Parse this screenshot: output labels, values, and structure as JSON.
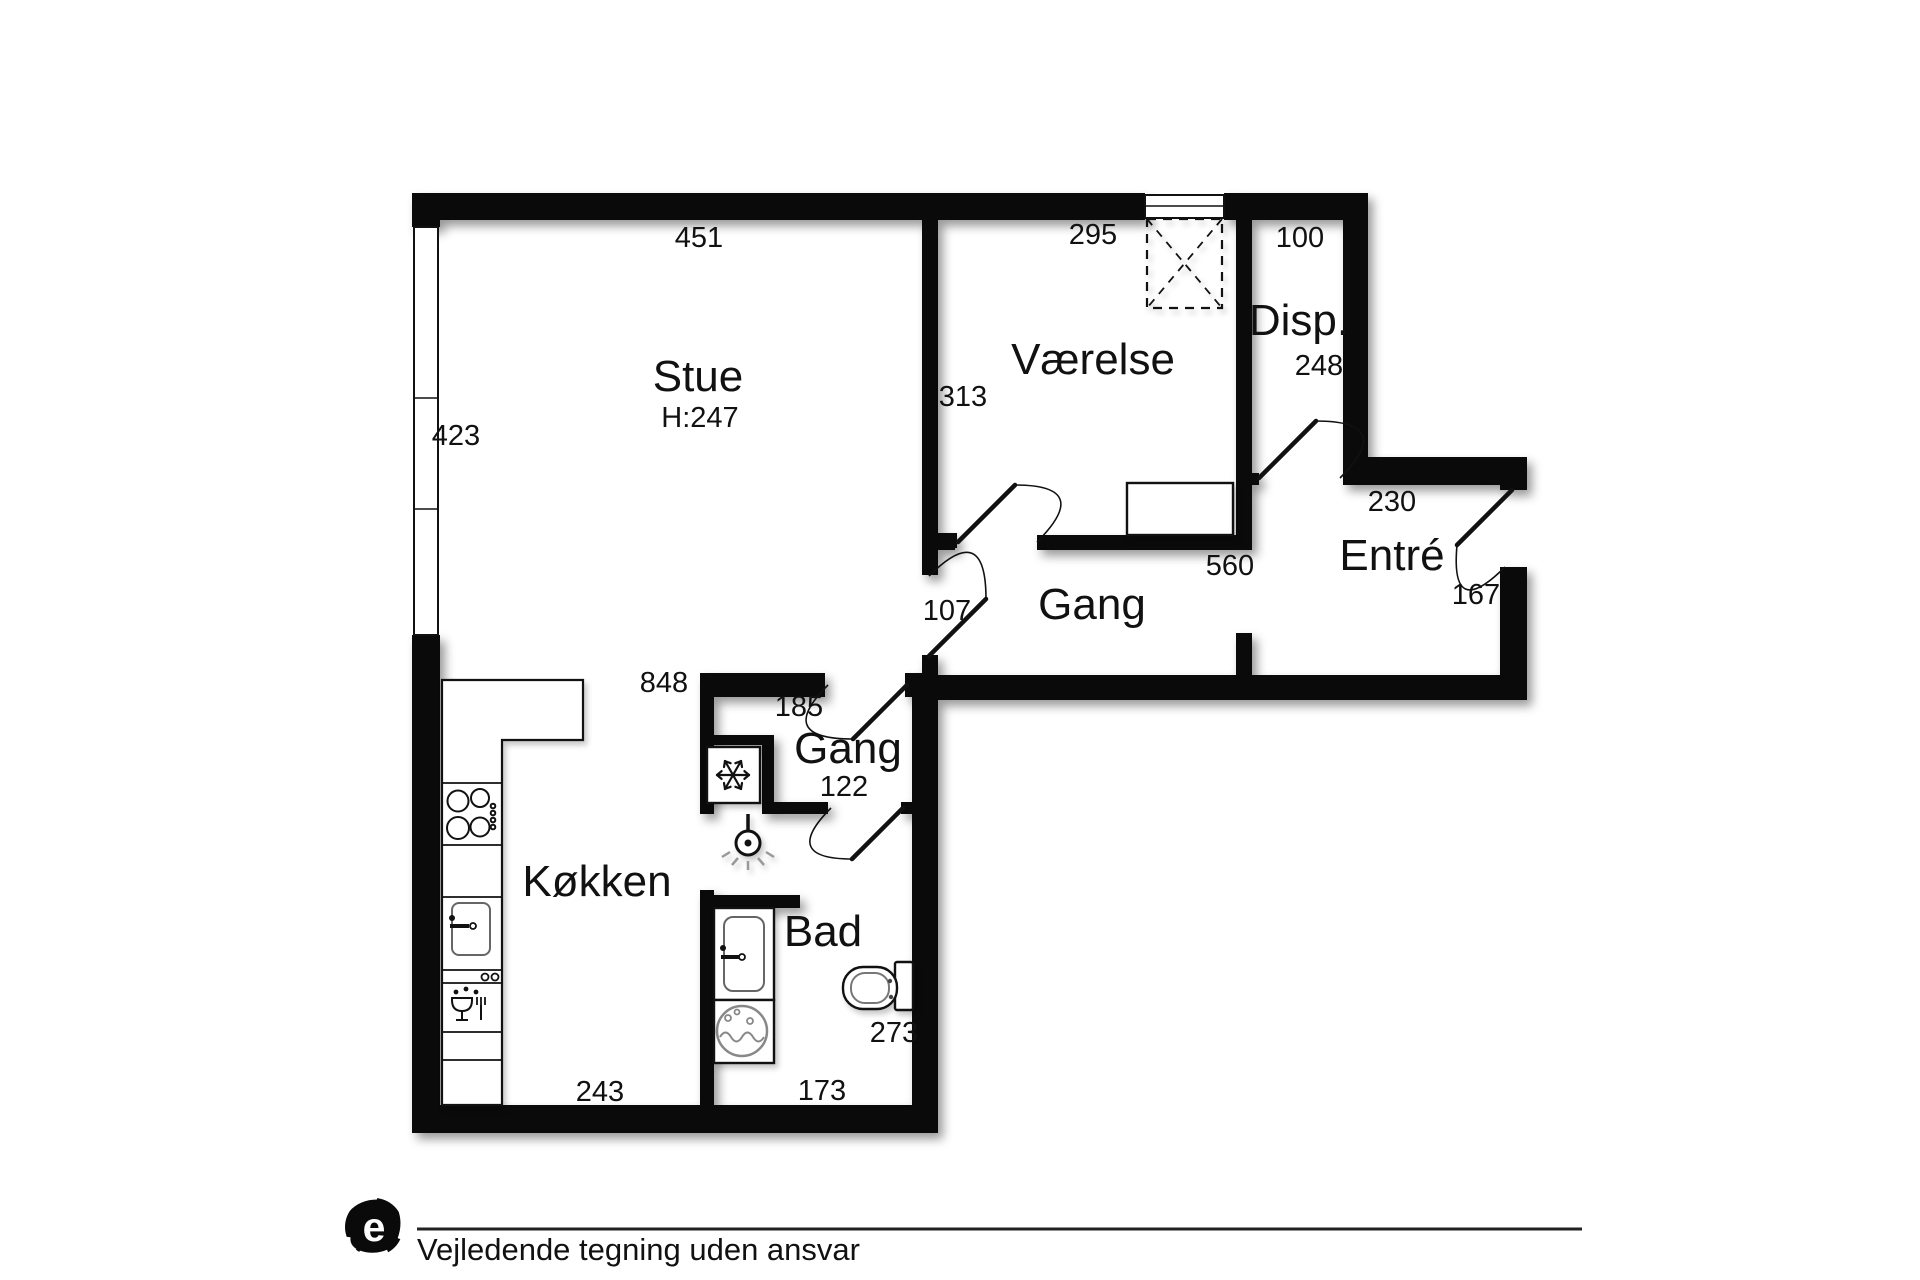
{
  "floorplan": {
    "rooms": [
      {
        "name": "Stue",
        "ceiling_height": "H:247",
        "dims": [
          "451",
          "423"
        ]
      },
      {
        "name": "Værelse",
        "dims": [
          "295",
          "313"
        ]
      },
      {
        "name": "Disp.",
        "dims": [
          "100",
          "248"
        ]
      },
      {
        "name": "Entré",
        "dims": [
          "230",
          "167"
        ]
      },
      {
        "name": "Gang",
        "dims": [
          "560",
          "107"
        ]
      },
      {
        "name": "Gang",
        "dims": [
          "848",
          "185",
          "122"
        ]
      },
      {
        "name": "Køkken",
        "dims": [
          "243"
        ]
      },
      {
        "name": "Bad",
        "dims": [
          "173",
          "273"
        ]
      }
    ],
    "icons": [
      "fridge-snowflake",
      "ceiling-lamp",
      "stove",
      "kitchen-sink",
      "dishwasher",
      "bathroom-sink",
      "washing-machine",
      "toilet",
      "wardrobe"
    ],
    "colors": {
      "wall": "#0a0a0a",
      "floor": "#ffffff"
    }
  },
  "footer": {
    "logo_letter": "e",
    "disclaimer": "Vejledende tegning uden ansvar"
  }
}
